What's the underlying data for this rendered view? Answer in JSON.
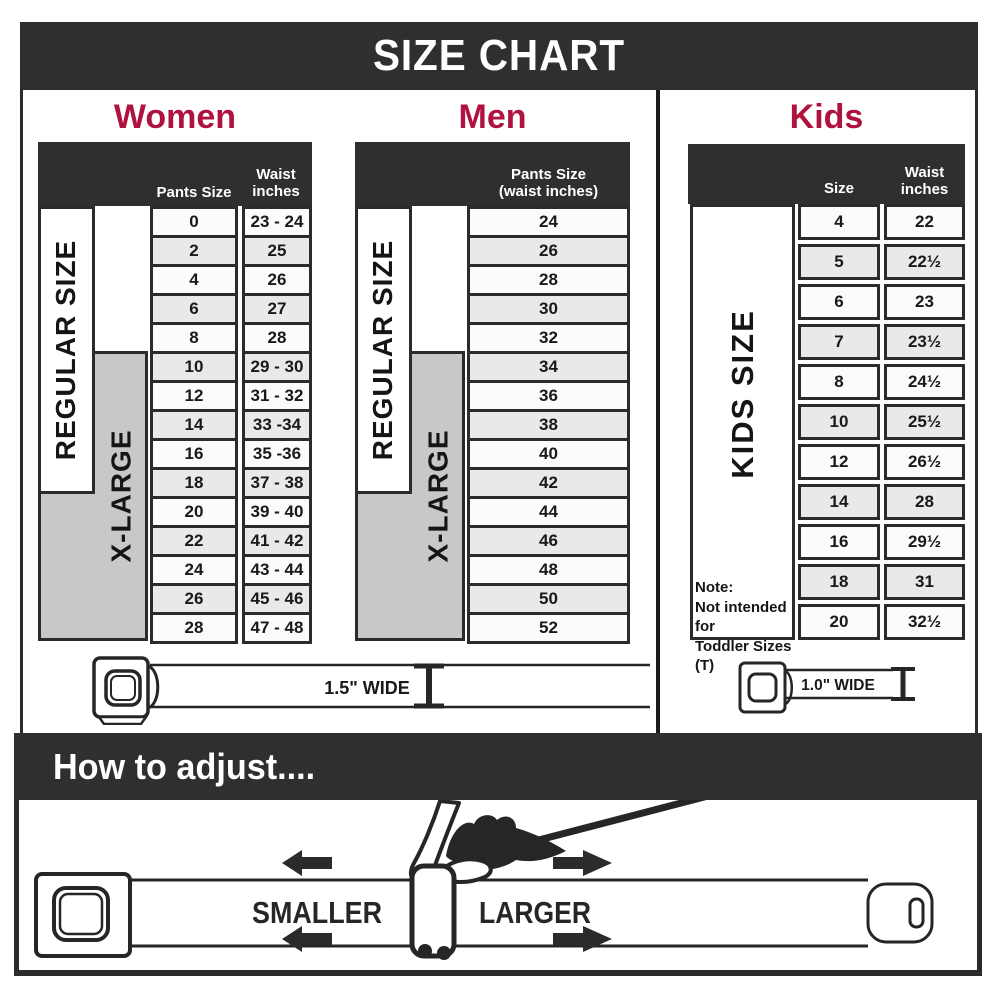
{
  "title": "SIZE CHART",
  "sections": {
    "women": {
      "heading": "Women",
      "col1_header": "Pants Size",
      "col2_header_line1": "Waist",
      "col2_header_line2": "inches",
      "side_regular": "REGULAR SIZE",
      "side_xlarge": "X-LARGE"
    },
    "men": {
      "heading": "Men",
      "header_line1": "Pants Size",
      "header_line2": "(waist inches)",
      "side_regular": "REGULAR SIZE",
      "side_xlarge": "X-LARGE"
    },
    "kids": {
      "heading": "Kids",
      "col1_header": "Size",
      "col2_header_line1": "Waist",
      "col2_header_line2": "inches",
      "side": "KIDS SIZE",
      "note_line1": "Note:",
      "note_line2": "Not intended for",
      "note_line3": "Toddler Sizes (T)"
    }
  },
  "belts": {
    "adult_width_label": "1.5\" WIDE",
    "kids_width_label": "1.0\" WIDE"
  },
  "adjust": {
    "heading": "How to adjust....",
    "smaller_label": "SMALLER",
    "larger_label": "LARGER"
  },
  "colors": {
    "band": "#2f2f2f",
    "accent": "#b01240",
    "row_alt": "#e9e9e9",
    "xlarge_gray": "#c8c8c8",
    "ink": "#262626"
  },
  "chart_data": [
    {
      "type": "table",
      "title": "Women",
      "columns": [
        "Pants Size",
        "Waist inches"
      ],
      "rows": [
        [
          "0",
          "23 - 24"
        ],
        [
          "2",
          "25"
        ],
        [
          "4",
          "26"
        ],
        [
          "6",
          "27"
        ],
        [
          "8",
          "28"
        ],
        [
          "10",
          "29 - 30"
        ],
        [
          "12",
          "31 - 32"
        ],
        [
          "14",
          "33 -34"
        ],
        [
          "16",
          "35 -36"
        ],
        [
          "18",
          "37 - 38"
        ],
        [
          "20",
          "39 - 40"
        ],
        [
          "22",
          "41 - 42"
        ],
        [
          "24",
          "43 - 44"
        ],
        [
          "26",
          "45 - 46"
        ],
        [
          "28",
          "47 - 48"
        ]
      ],
      "size_groups": [
        {
          "label": "REGULAR SIZE",
          "sizes": "0–18"
        },
        {
          "label": "X-LARGE",
          "sizes": "10–28"
        }
      ],
      "belt_width": "1.5\" WIDE"
    },
    {
      "type": "table",
      "title": "Men",
      "columns": [
        "Pants Size (waist inches)"
      ],
      "rows": [
        [
          "24"
        ],
        [
          "26"
        ],
        [
          "28"
        ],
        [
          "30"
        ],
        [
          "32"
        ],
        [
          "34"
        ],
        [
          "36"
        ],
        [
          "38"
        ],
        [
          "40"
        ],
        [
          "42"
        ],
        [
          "44"
        ],
        [
          "46"
        ],
        [
          "48"
        ],
        [
          "50"
        ],
        [
          "52"
        ]
      ],
      "size_groups": [
        {
          "label": "REGULAR SIZE",
          "sizes": "24–42"
        },
        {
          "label": "X-LARGE",
          "sizes": "34–52"
        }
      ],
      "belt_width": "1.5\" WIDE"
    },
    {
      "type": "table",
      "title": "Kids",
      "columns": [
        "Size",
        "Waist inches"
      ],
      "rows": [
        [
          "4",
          "22"
        ],
        [
          "5",
          "22½"
        ],
        [
          "6",
          "23"
        ],
        [
          "7",
          "23½"
        ],
        [
          "8",
          "24½"
        ],
        [
          "10",
          "25½"
        ],
        [
          "12",
          "26½"
        ],
        [
          "14",
          "28"
        ],
        [
          "16",
          "29½"
        ],
        [
          "18",
          "31"
        ],
        [
          "20",
          "32½"
        ]
      ],
      "size_groups": [
        {
          "label": "KIDS SIZE",
          "sizes": "4–20"
        }
      ],
      "note": "Note: Not intended for Toddler Sizes (T)",
      "belt_width": "1.0\" WIDE"
    }
  ]
}
